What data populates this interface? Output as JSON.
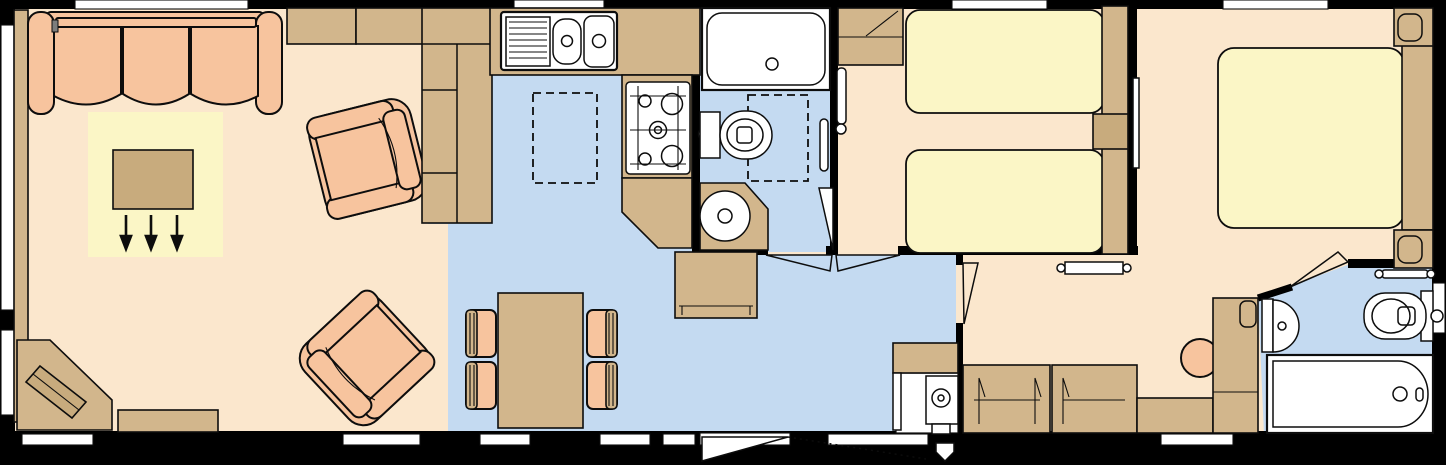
{
  "palette": {
    "bg": "#000000",
    "wall": "#000000",
    "outline": "#0d0d0d",
    "floor": "#fbe7cd",
    "wet": "#c4daf1",
    "rug": "#fbf6c6",
    "bed": "#fbf6c6",
    "wood": "#d2b68c",
    "wood2": "#c8ab7d",
    "uph": "#f7c49e",
    "fixture": "#ffffff"
  },
  "plan": {
    "type": "static-caravan-floor-plan",
    "orientation": "side-elevation-top-view",
    "rooms": [
      {
        "name": "lounge",
        "floor": "main",
        "furniture": [
          "three-seat-sofa",
          "rug",
          "coffee-table",
          "pull-out-bed-arrows",
          "armchair",
          "armchair",
          "corner-tv-unit",
          "tv",
          "sideboard-shelf",
          "low-unit",
          "overhead-lockers"
        ]
      },
      {
        "name": "kitchen",
        "floor": "wet",
        "furniture": [
          "sink-with-drainer",
          "worktop",
          "tall-larder-fridge-units",
          "gas-hob",
          "overhead-lockers-dashed",
          "freestanding-unit",
          "dining-table",
          "dining-chair",
          "dining-chair",
          "dining-chair",
          "dining-chair"
        ]
      },
      {
        "name": "family-bathroom",
        "floor": "wet",
        "furniture": [
          "bathtub",
          "toilet",
          "corner-washbasin",
          "towel-rail",
          "overhead-locker-dashed"
        ]
      },
      {
        "name": "hallway",
        "floor": "wet",
        "furniture": [
          "entrance-door",
          "boiler-cupboard",
          "boiler",
          "flue"
        ]
      },
      {
        "name": "twin-bedroom",
        "floor": "main",
        "furniture": [
          "single-bed",
          "single-bed",
          "headboard-shelf",
          "bedside-shelf",
          "wardrobe",
          "radiator"
        ]
      },
      {
        "name": "master-bedroom",
        "floor": "main",
        "furniture": [
          "double-bed",
          "headboard",
          "bedside-cabinet",
          "bedside-cabinet",
          "chest-of-drawers",
          "chest-of-drawers",
          "dressing-table",
          "stool",
          "wardrobe",
          "mirror",
          "radiator"
        ]
      },
      {
        "name": "en-suite",
        "floor": "wet",
        "furniture": [
          "bathtub",
          "toilet",
          "semicircle-basin",
          "towel-rail"
        ]
      }
    ],
    "window_count": 14,
    "external_door_count": 1,
    "internal_door_count": 4
  }
}
